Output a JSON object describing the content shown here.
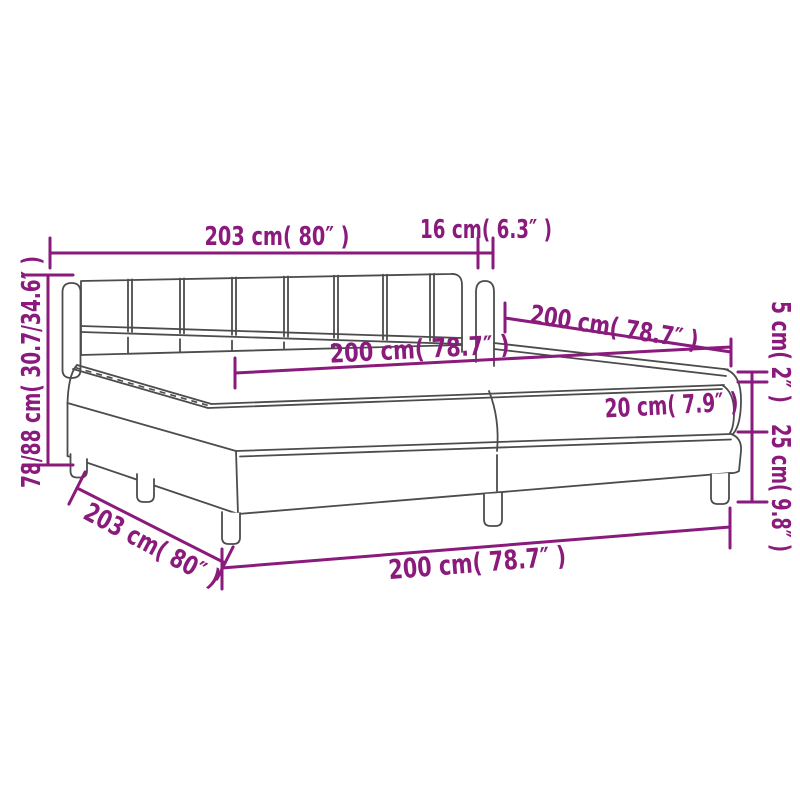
{
  "diagram": {
    "subject": "box-spring-bed-with-headboard-dimension-diagram",
    "labels": {
      "headboard_width": "203 cm( 80″ )",
      "wing_depth": "16 cm( 6.3″ )",
      "headboard_height": "78/88 cm( 30.7/34.6″ )",
      "length_upper": "200 cm( 78.7″ )",
      "surface_length": "200 cm( 78.7″ )",
      "mattress_height": "20 cm( 7.9″ )",
      "topper_height": "5 cm( 2″ )",
      "base_height": "25 cm( 9.8″ )",
      "side_depth": "203 cm( 80″ )",
      "length_lower": "200 cm( 78.7″ )"
    }
  },
  "colors": {
    "dimension_color": "#8a1a7b",
    "line_color": "#4c4c4c",
    "background": "#ffffff"
  }
}
